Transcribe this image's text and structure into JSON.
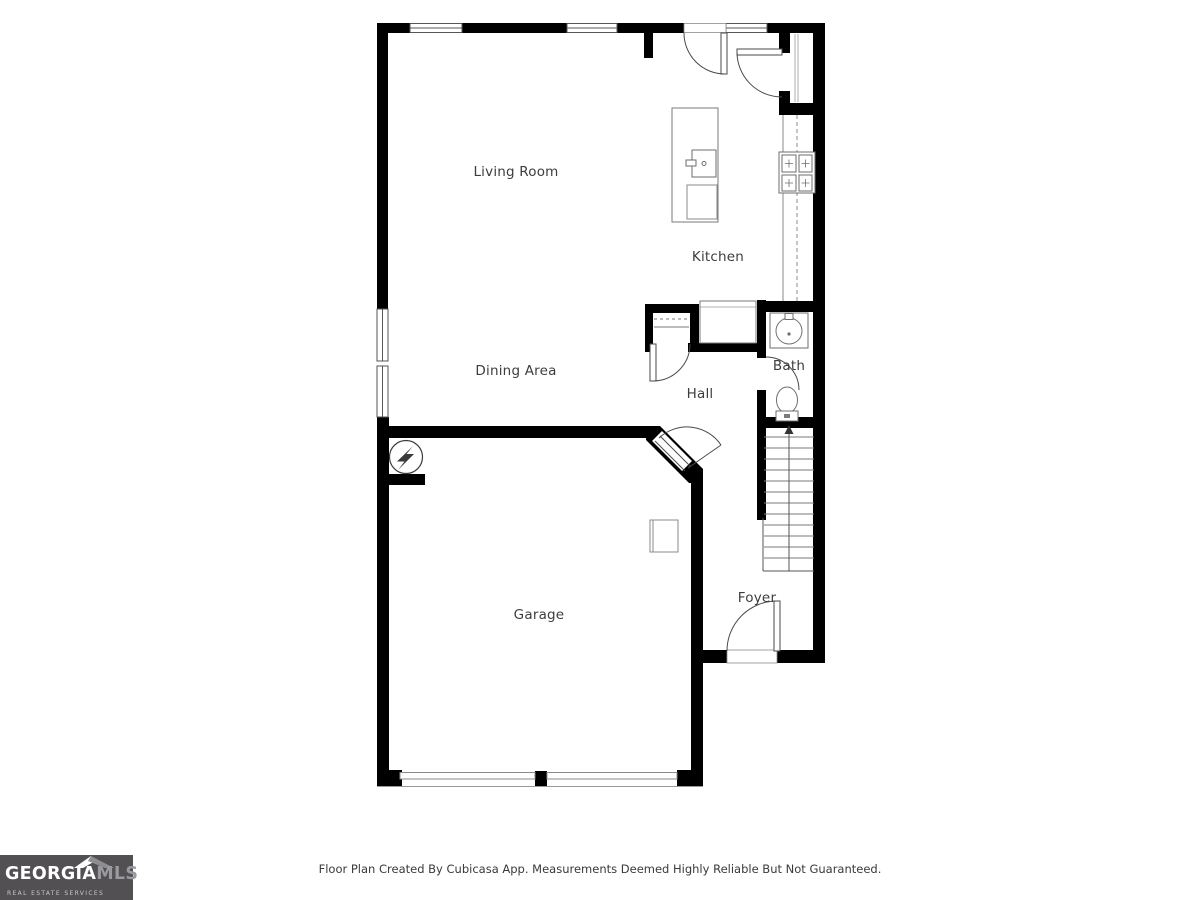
{
  "rooms": {
    "living_room": "Living Room",
    "kitchen": "Kitchen",
    "dining_area": "Dining Area",
    "hall": "Hall",
    "bath": "Bath",
    "garage": "Garage",
    "foyer": "Foyer"
  },
  "footer": {
    "disclaimer": "Floor Plan Created By Cubicasa App. Measurements Deemed Highly Reliable But Not Guaranteed."
  },
  "logo": {
    "brand_primary": "GEORGIA",
    "brand_secondary": "MLS",
    "tagline": "REAL ESTATE SERVICES",
    "bg_color": "#525053",
    "primary_color": "#ffffff",
    "secondary_color": "#9a999e"
  },
  "plan": {
    "wall_color": "#000000",
    "fixture_line_color": "#6e6e6e",
    "label_color": "#3d3d3d",
    "symbols": [
      "window",
      "door-swing",
      "pantry-shelves",
      "kitchen-counter",
      "stove",
      "kitchen-island",
      "island-sink",
      "dishwasher",
      "refrigerator",
      "closet-shelves",
      "bathroom-sink-vanity",
      "toilet",
      "stairs-up-arrow",
      "electrical-panel",
      "water-heater",
      "garage-door",
      "front-door"
    ]
  }
}
